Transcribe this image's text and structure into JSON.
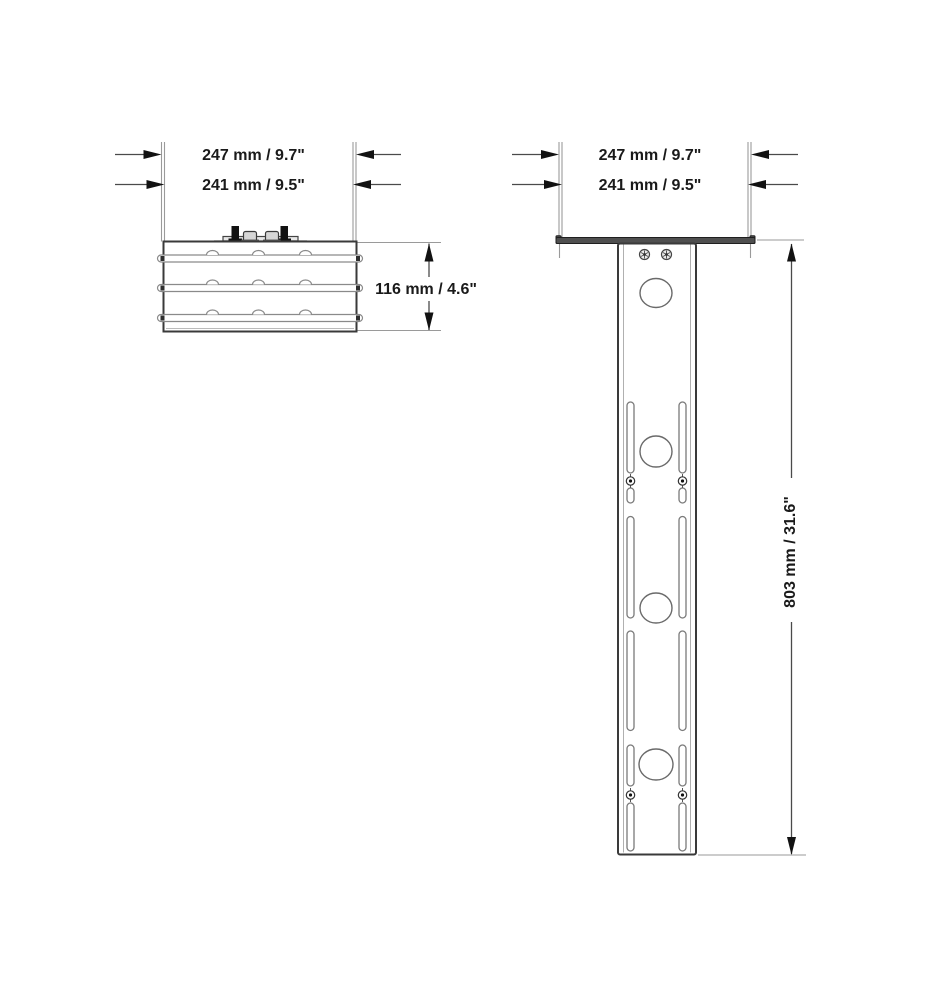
{
  "drawing": {
    "colors": {
      "background": "#ffffff",
      "object_line": "#3a3a3a",
      "extension_line": "#9a9a9a",
      "dimension_text": "#1a1a1a",
      "flange_fill": "#4f4f4f",
      "bolt_fill": "#111111"
    },
    "views": {
      "side": {
        "width_outer": "247 mm / 9.7\"",
        "width_inner": "241 mm / 9.5\"",
        "height": "116 mm / 4.6\""
      },
      "front": {
        "width_outer": "247 mm / 9.7\"",
        "width_inner": "241 mm / 9.5\"",
        "height": "803 mm / 31.6\""
      }
    }
  }
}
